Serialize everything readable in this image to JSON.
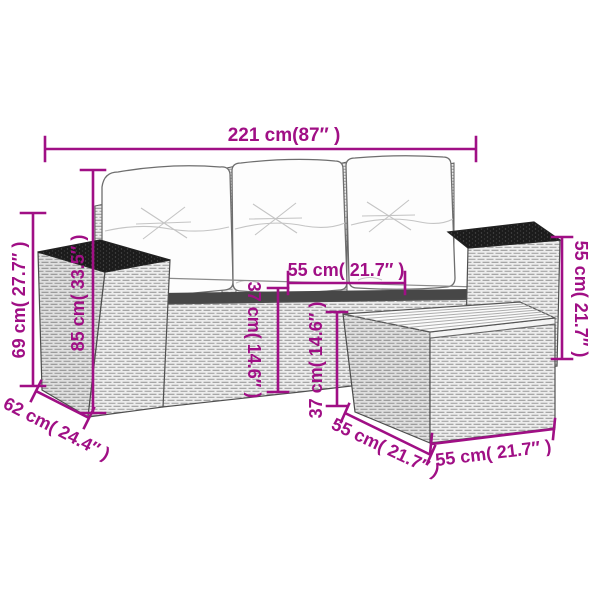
{
  "colors": {
    "accent": "#a00f85",
    "background": "#ffffff"
  },
  "labels": {
    "overall_width": "221 cm(87″ )",
    "sofa_height": "69 cm( 27.7″ )",
    "back_height": "85 cm( 33.5″ )",
    "sofa_depth": "62 cm( 24.4″ )",
    "seat_width": "55 cm( 21.7″ )",
    "seat_height": "37 cm( 14.6″ )",
    "table_height": "37 cm( 14.6″ )",
    "armrest_height": "55 cm( 21.7″ )",
    "table_depth": "55 cm( 21.7″ )",
    "table_width": "55 cm( 21.7″ )"
  }
}
